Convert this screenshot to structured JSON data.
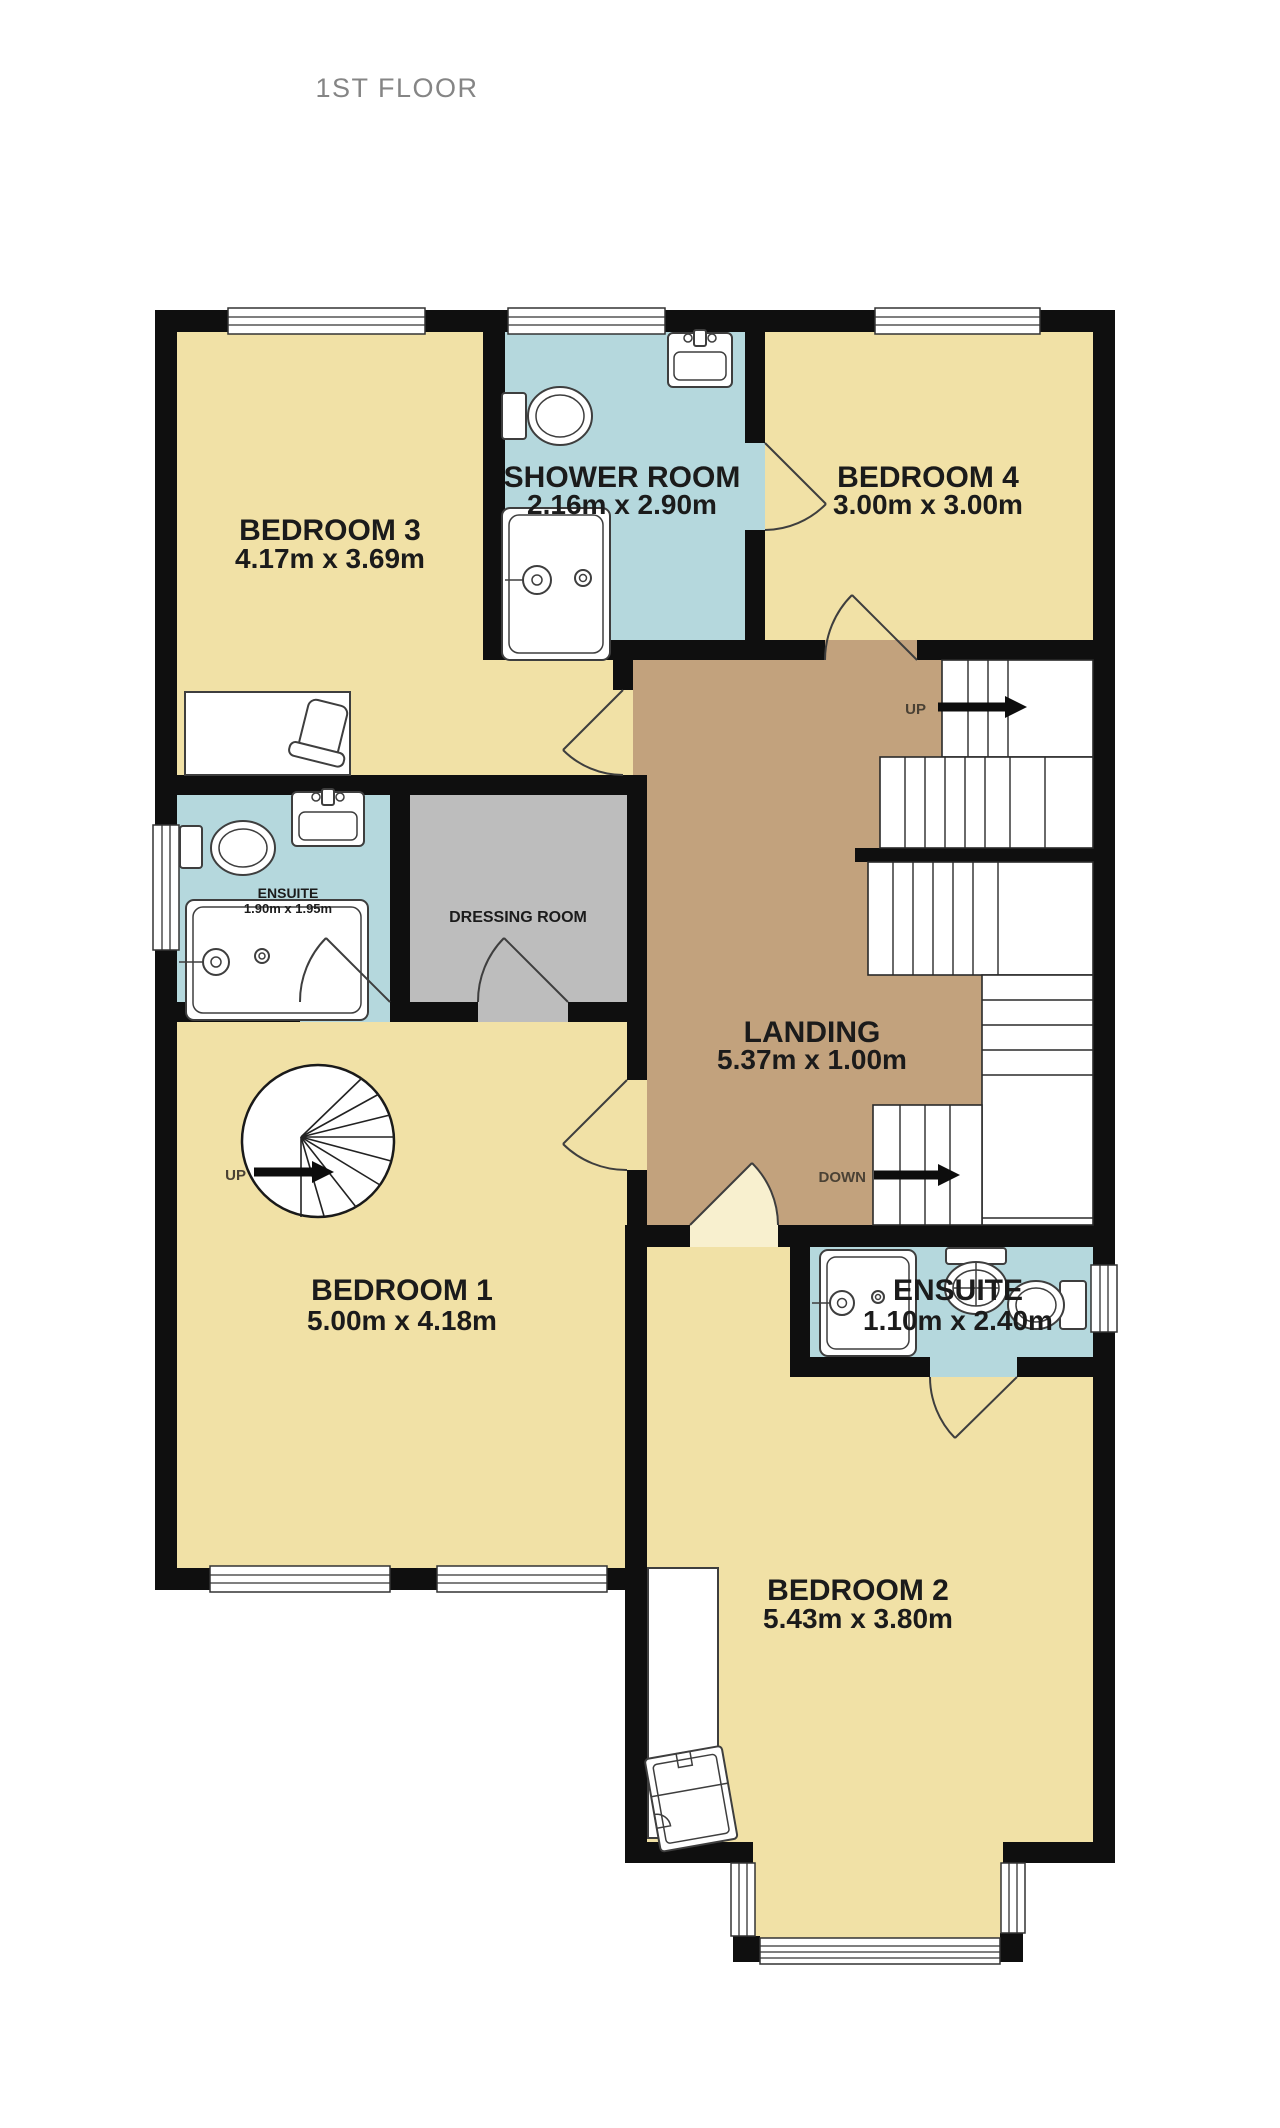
{
  "title": "1ST FLOOR",
  "rooms": {
    "bedroom3": {
      "name": "BEDROOM 3",
      "dims": "4.17m x 3.69m"
    },
    "shower_room": {
      "name": "SHOWER ROOM",
      "dims": "2.16m x 2.90m"
    },
    "bedroom4": {
      "name": "BEDROOM 4",
      "dims": "3.00m x 3.00m"
    },
    "ensuite_left": {
      "name": "ENSUITE",
      "dims": "1.90m x 1.95m"
    },
    "dressing_room": {
      "name": "DRESSING ROOM"
    },
    "landing": {
      "name": "LANDING",
      "dims": "5.37m x 1.00m"
    },
    "bedroom1": {
      "name": "BEDROOM 1",
      "dims": "5.00m x 4.18m"
    },
    "ensuite_right": {
      "name": "ENSUITE",
      "dims": "1.10m x 2.40m"
    },
    "bedroom2": {
      "name": "BEDROOM 2",
      "dims": "5.43m x 3.80m"
    }
  },
  "stairs": {
    "up_label": "UP",
    "down_label": "DOWN",
    "spiral_up_label": "UP"
  },
  "colors": {
    "wall": "#0f0f0f",
    "yellow": "#f1e1a6",
    "paleyellow": "#f8f0cf",
    "blue": "#b5d8dd",
    "gray": "#bdbdbd",
    "brown": "#c2a27d",
    "label": "#1b1b1b",
    "title": "#858585",
    "updown": "#4a4134"
  }
}
